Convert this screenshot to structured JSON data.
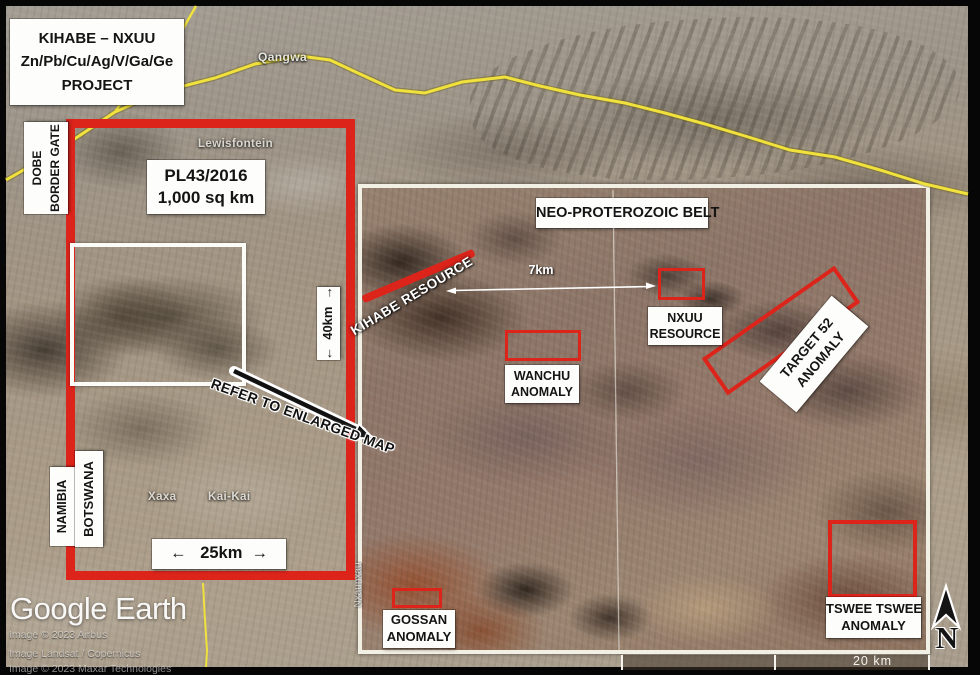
{
  "project_box": {
    "line1": "KIHABE – NXUU",
    "line2": "Zn/Pb/Cu/Ag/V/Ga/Ge",
    "line3": "PROJECT"
  },
  "license_box": {
    "line1": "PL43/2016",
    "line2": "1,000 sq km"
  },
  "dobe_box": {
    "line1": "DOBE",
    "line2": "BORDER GATE"
  },
  "border_labels": {
    "namibia": "NAMIBIA",
    "botswana": "BOTSWANA"
  },
  "dimension_labels": {
    "vertical": "←  40km  →",
    "horizontal": "←   25km  →"
  },
  "places": {
    "qangwa": "Qangwa",
    "lewisfontein": "Lewisfontein",
    "xaxa": "Xaxa",
    "kai_kai": "Kai-Kai",
    "nxaunxau": "Nxaunxau"
  },
  "refer_arrow_label": "REFER TO ENLARGED MAP",
  "enlarged_map": {
    "belt_label": "NEO-PROTEROZOIC BELT",
    "kihabe_resource": "KIHABE RESOURCE",
    "distance_label": "7km",
    "nxuu_resource": {
      "line1": "NXUU",
      "line2": "RESOURCE"
    },
    "wanchu": {
      "line1": "WANCHU",
      "line2": "ANOMALY"
    },
    "target_52": {
      "line1": "TARGET 52",
      "line2": "ANOMALY"
    },
    "tswee_tswee": {
      "line1": "TSWEE TSWEE",
      "line2": "ANOMALY"
    },
    "gossan": {
      "line1": "GOSSAN",
      "line2": "ANOMALY"
    },
    "scale_bar": "20 km",
    "north_label": "N"
  },
  "watermark": {
    "logo": "Google Earth",
    "credit1": "Image © 2023 Airbus",
    "credit2": "Image Landsat / Copernicus",
    "credit3": "Image © 2023 Maxar Technologies"
  },
  "colors": {
    "annotation_red": "#dd241b",
    "road_yellow": "#f0e13c",
    "label_bg": "#fdfdfb",
    "label_text": "#141414"
  }
}
